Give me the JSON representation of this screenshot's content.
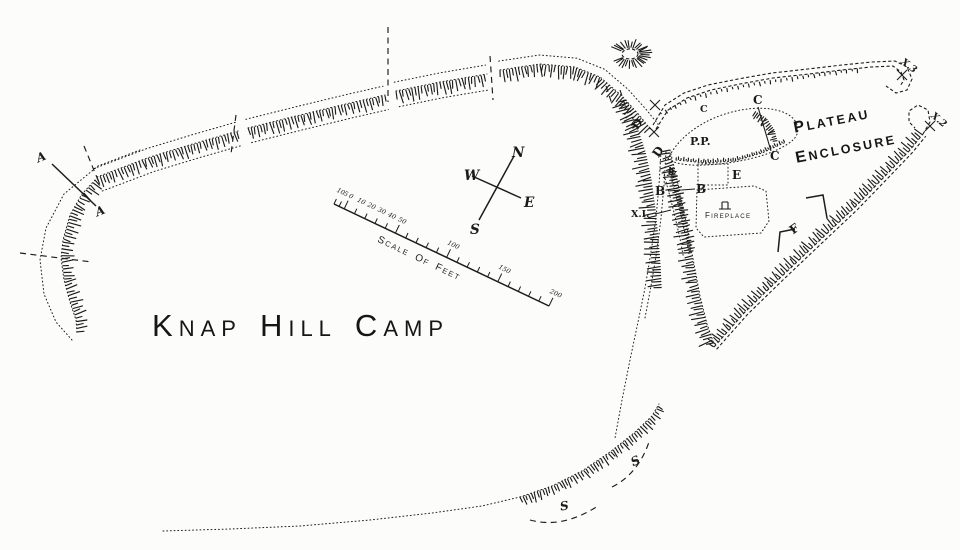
{
  "title": {
    "words": [
      {
        "initial": "K",
        "rest": "NAP"
      },
      {
        "initial": "H",
        "rest": "ILL"
      },
      {
        "initial": "C",
        "rest": "AMP"
      }
    ]
  },
  "compass": {
    "north": "N",
    "south": "S",
    "east": "E",
    "west": "W"
  },
  "scale_bar": {
    "caption_words": [
      {
        "initial": "S",
        "rest": "CALE"
      },
      {
        "initial": "O",
        "rest": "F"
      },
      {
        "initial": "F",
        "rest": "EET"
      }
    ],
    "unit": "feet",
    "range_feet": [
      -10,
      200
    ],
    "tick_labels": [
      {
        "text": "10",
        "feet": -10
      },
      {
        "text": "5",
        "feet": -5
      },
      {
        "text": "0",
        "feet": 0
      },
      {
        "text": "10",
        "feet": 10
      },
      {
        "text": "20",
        "feet": 20
      },
      {
        "text": "30",
        "feet": 30
      },
      {
        "text": "40",
        "feet": 40
      },
      {
        "text": "50",
        "feet": 50
      },
      {
        "text": "100",
        "feet": 100
      },
      {
        "text": "150",
        "feet": 150
      },
      {
        "text": "200",
        "feet": 200
      }
    ]
  },
  "enclosure": {
    "name_words": [
      {
        "initial": "P",
        "rest": "LATEAU"
      },
      {
        "initial": "E",
        "rest": "NCLOSURE"
      }
    ]
  },
  "labels": {
    "section_a": "A",
    "section_b": "B",
    "section_c": "C",
    "section_d": "D",
    "cutting_e": "E",
    "section_f": "F",
    "pit_pp": "P.P.",
    "x1": "X.I.",
    "x2": "X.2",
    "x3": "X.3",
    "scarp": "S",
    "small_mark": "h",
    "fireplace_words": [
      {
        "initial": "F",
        "rest": "IREPLACE"
      }
    ]
  },
  "colors": {
    "ink": "#1c1c1c",
    "paper": "#fcfcfa"
  }
}
